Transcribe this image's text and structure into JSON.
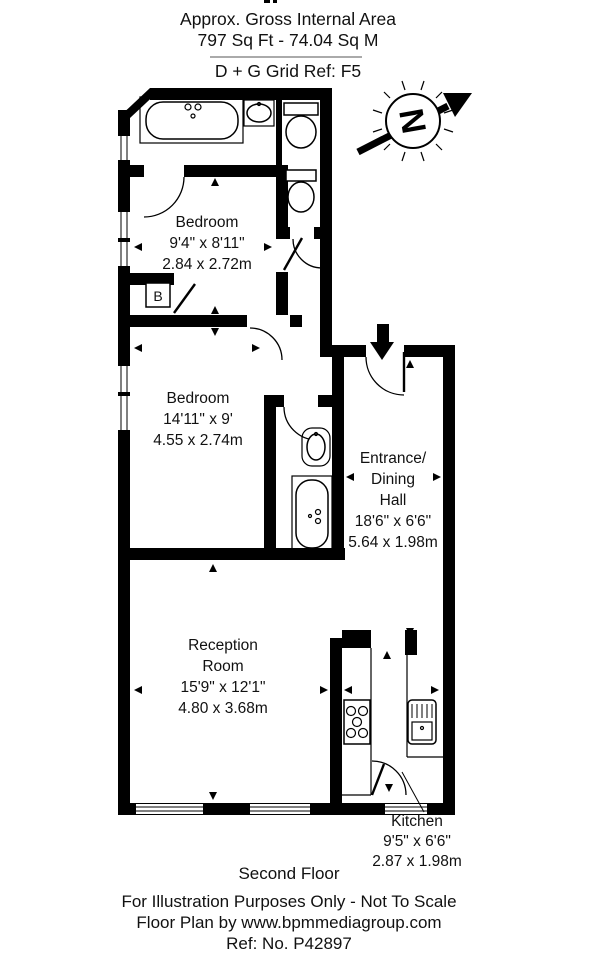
{
  "header": {
    "area_label": "Approx. Gross Internal Area",
    "area_value": "797 Sq Ft  -  74.04 Sq M",
    "grid_ref": "D + G Grid Ref: F5"
  },
  "compass": {
    "north_letter": "N"
  },
  "rooms": {
    "bedroom1": {
      "name": "Bedroom",
      "size_imperial": "9'4\" x 8'11\"",
      "size_metric": "2.84 x 2.72m"
    },
    "bedroom2": {
      "name": "Bedroom",
      "size_imperial": "14'11\" x 9'",
      "size_metric": "4.55 x 2.74m"
    },
    "hall": {
      "name_line1": "Entrance/",
      "name_line2": "Dining",
      "name_line3": "Hall",
      "size_imperial": "18'6\" x 6'6\"",
      "size_metric": "5.64 x 1.98m"
    },
    "reception": {
      "name_line1": "Reception",
      "name_line2": "Room",
      "size_imperial": "15'9\" x 12'1\"",
      "size_metric": "4.80 x 3.68m"
    },
    "kitchen": {
      "name": "Kitchen",
      "size_imperial": "9'5\" x 6'6\"",
      "size_metric": "2.87 x 1.98m"
    }
  },
  "annotations": {
    "boiler": "B"
  },
  "footer": {
    "floor": "Second Floor",
    "disclaimer": "For Illustration Purposes Only - Not To Scale",
    "credit": "Floor Plan by www.bpmmediagroup.com",
    "reference": "Ref: No. P42897"
  },
  "colors": {
    "wall": "#000000",
    "background": "#ffffff",
    "divider_line": "#aaaaaa"
  }
}
